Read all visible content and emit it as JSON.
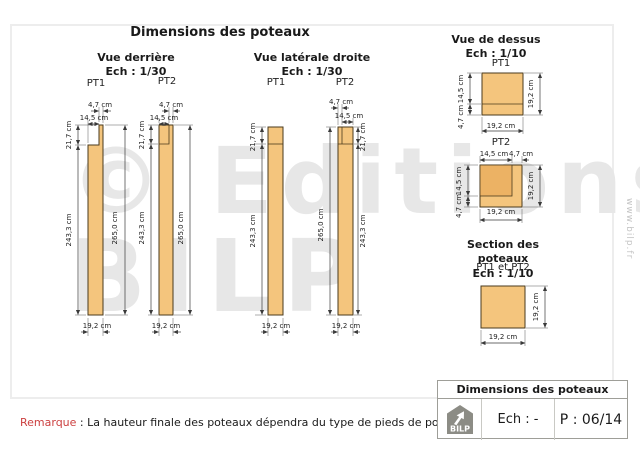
{
  "page": {
    "main_title": "Dimensions des poteaux",
    "watermark": {
      "line1": "© Editions",
      "line2": "BILP"
    },
    "website_vertical": "www.bilp.fr"
  },
  "views": {
    "rear": {
      "title": "Vue derrière",
      "scale": "Ech : 1/30",
      "pt1_label": "PT1",
      "pt2_label": "PT2"
    },
    "side": {
      "title": "Vue latérale droite",
      "scale": "Ech : 1/30",
      "pt1_label": "PT1",
      "pt2_label": "PT2"
    },
    "top": {
      "title": "Vue de dessus",
      "scale": "Ech : 1/10",
      "pt1_label": "PT1",
      "pt2_label": "PT2"
    },
    "section": {
      "title": "Section des poteaux",
      "scale": "Ech : 1/10",
      "subtitle": "PT1 et PT2"
    }
  },
  "dimensions": {
    "tenon_width": "4,7 cm",
    "shoulder_width": "14,5 cm",
    "post_width": "19,2 cm",
    "tenon_height": "21,7 cm",
    "body_height": "243,3 cm",
    "total_height": "265,0 cm"
  },
  "remark": {
    "label": "Remarque",
    "text": " : La hauteur finale des poteaux dépendra du type de pieds de poteau employé"
  },
  "title_block": {
    "title": "Dimensions des poteaux",
    "scale": "Ech : -",
    "page_number": "P : 06/14",
    "logo_text": "BILP"
  },
  "colors": {
    "wood_fill": "#f4c57d",
    "wood_notch_fill": "#ecb264",
    "remark_red": "#cc4040",
    "watermark_grey": "#e7e7e7",
    "frame_grey": "#ededed"
  }
}
